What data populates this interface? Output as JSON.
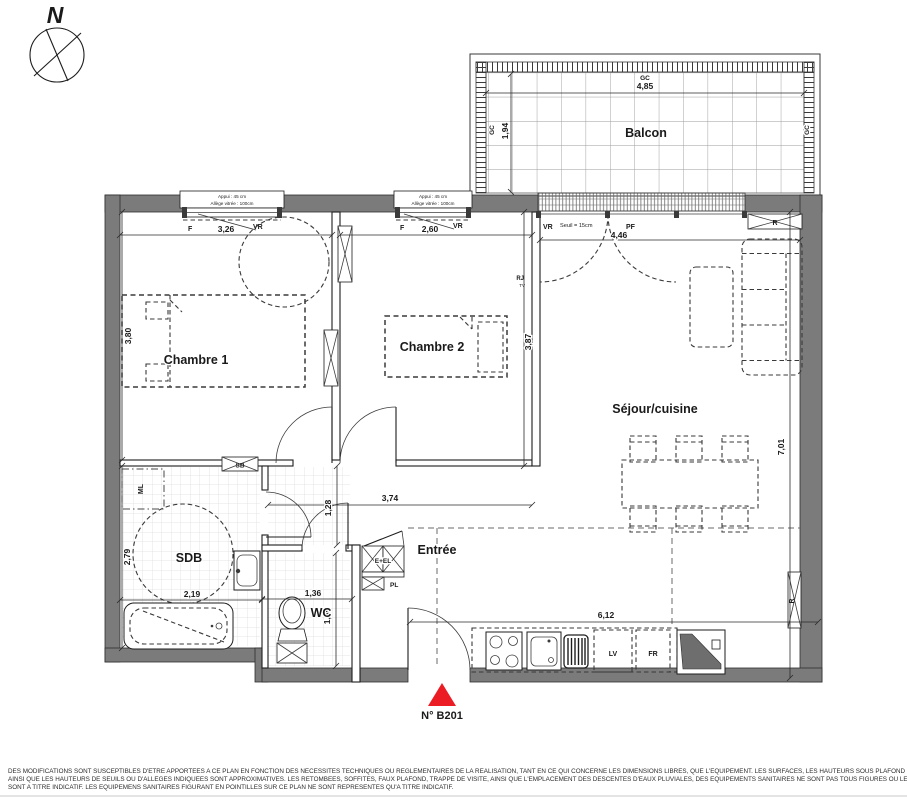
{
  "compass": {
    "north": "N"
  },
  "marker": {
    "unit": "N° B201"
  },
  "balcony": {
    "label": "Balcon",
    "gc_top": "GC",
    "gc_top_length": "4,85",
    "gc_left": "GC",
    "gc_left_depth": "1,94",
    "gc_right": "GC"
  },
  "openings": {
    "window1": {
      "appui": "Appui : 45 cm",
      "allege": "Allège vitrée : 100cm",
      "f": "F",
      "vr": "VR",
      "width": "3,26"
    },
    "window2": {
      "appui": "Appui : 45 cm",
      "allege": "Allège vitrée : 100cm",
      "f": "F",
      "vr": "VR",
      "width": "2,60"
    },
    "bay": {
      "vr": "VR",
      "seuil": "Seuil = 15cm",
      "pf": "PF",
      "width": "4,46"
    }
  },
  "rooms": {
    "chambre1": {
      "name": "Chambre 1",
      "depth": "3,80"
    },
    "chambre2": {
      "name": "Chambre 2",
      "depth": "3,87"
    },
    "sejour": {
      "name": "Séjour/cuisine",
      "depth": "7,01"
    },
    "sdb": {
      "name": "SDB",
      "depth": "2,79",
      "width": "2,19"
    },
    "wc": {
      "name": "WC",
      "width": "1,36",
      "depth": "1,85"
    },
    "entree": {
      "name": "Entrée"
    },
    "hall": {
      "length": "3,74",
      "width": "1,28"
    },
    "kitchen": {
      "length": "6,12"
    }
  },
  "equipment": {
    "ml": "ML",
    "sb": "SB",
    "eel": "E+EL",
    "pl": "PL",
    "rj": "RJ",
    "tv": "TV",
    "radiator": "R",
    "lv": "LV",
    "fr": "FR"
  },
  "disclaimer": {
    "line1": "DES MODIFICATIONS SONT SUSCEPTIBLES D'ETRE APPORTEES A CE PLAN EN FONCTION DES NECESSITES TECHNIQUES OU REGLEMENTAIRES DE LA REALISATION, TANT EN CE QUI CONCERNE LES DIMENSIONS LIBRES, QUE L'EQUIPEMENT. LES SURFACES, LES HAUTEURS SOUS PLAFOND",
    "line2": "AINSI QUE LES HAUTEURS DE SEUILS OU D'ALLEGES INDIQUEES SONT APPROXIMATIVES. LES RETOMBEES, SOFFITES, FAUX PLAFOND, TRAPPE DE VISITE, AINSI QUE L'EMPLACEMENT DES DESCENTES D'EAUX PLUVIALES, DES EQUIPEMENTS SANITAIRES NE SONT PAS TOUS FIGURES OU LE",
    "line3": "SONT A TITRE INDICATIF. LES EQUIPEMENS SANITAIRES FIGURANT EN POINTILLES SUR CE PLAN NE SONT REPRESENTES QU'A TITRE INDICATIF."
  },
  "colors": {
    "wall": "#7b7b7b",
    "marker_red": "#ec1c24",
    "line": "#1d1d1d"
  }
}
